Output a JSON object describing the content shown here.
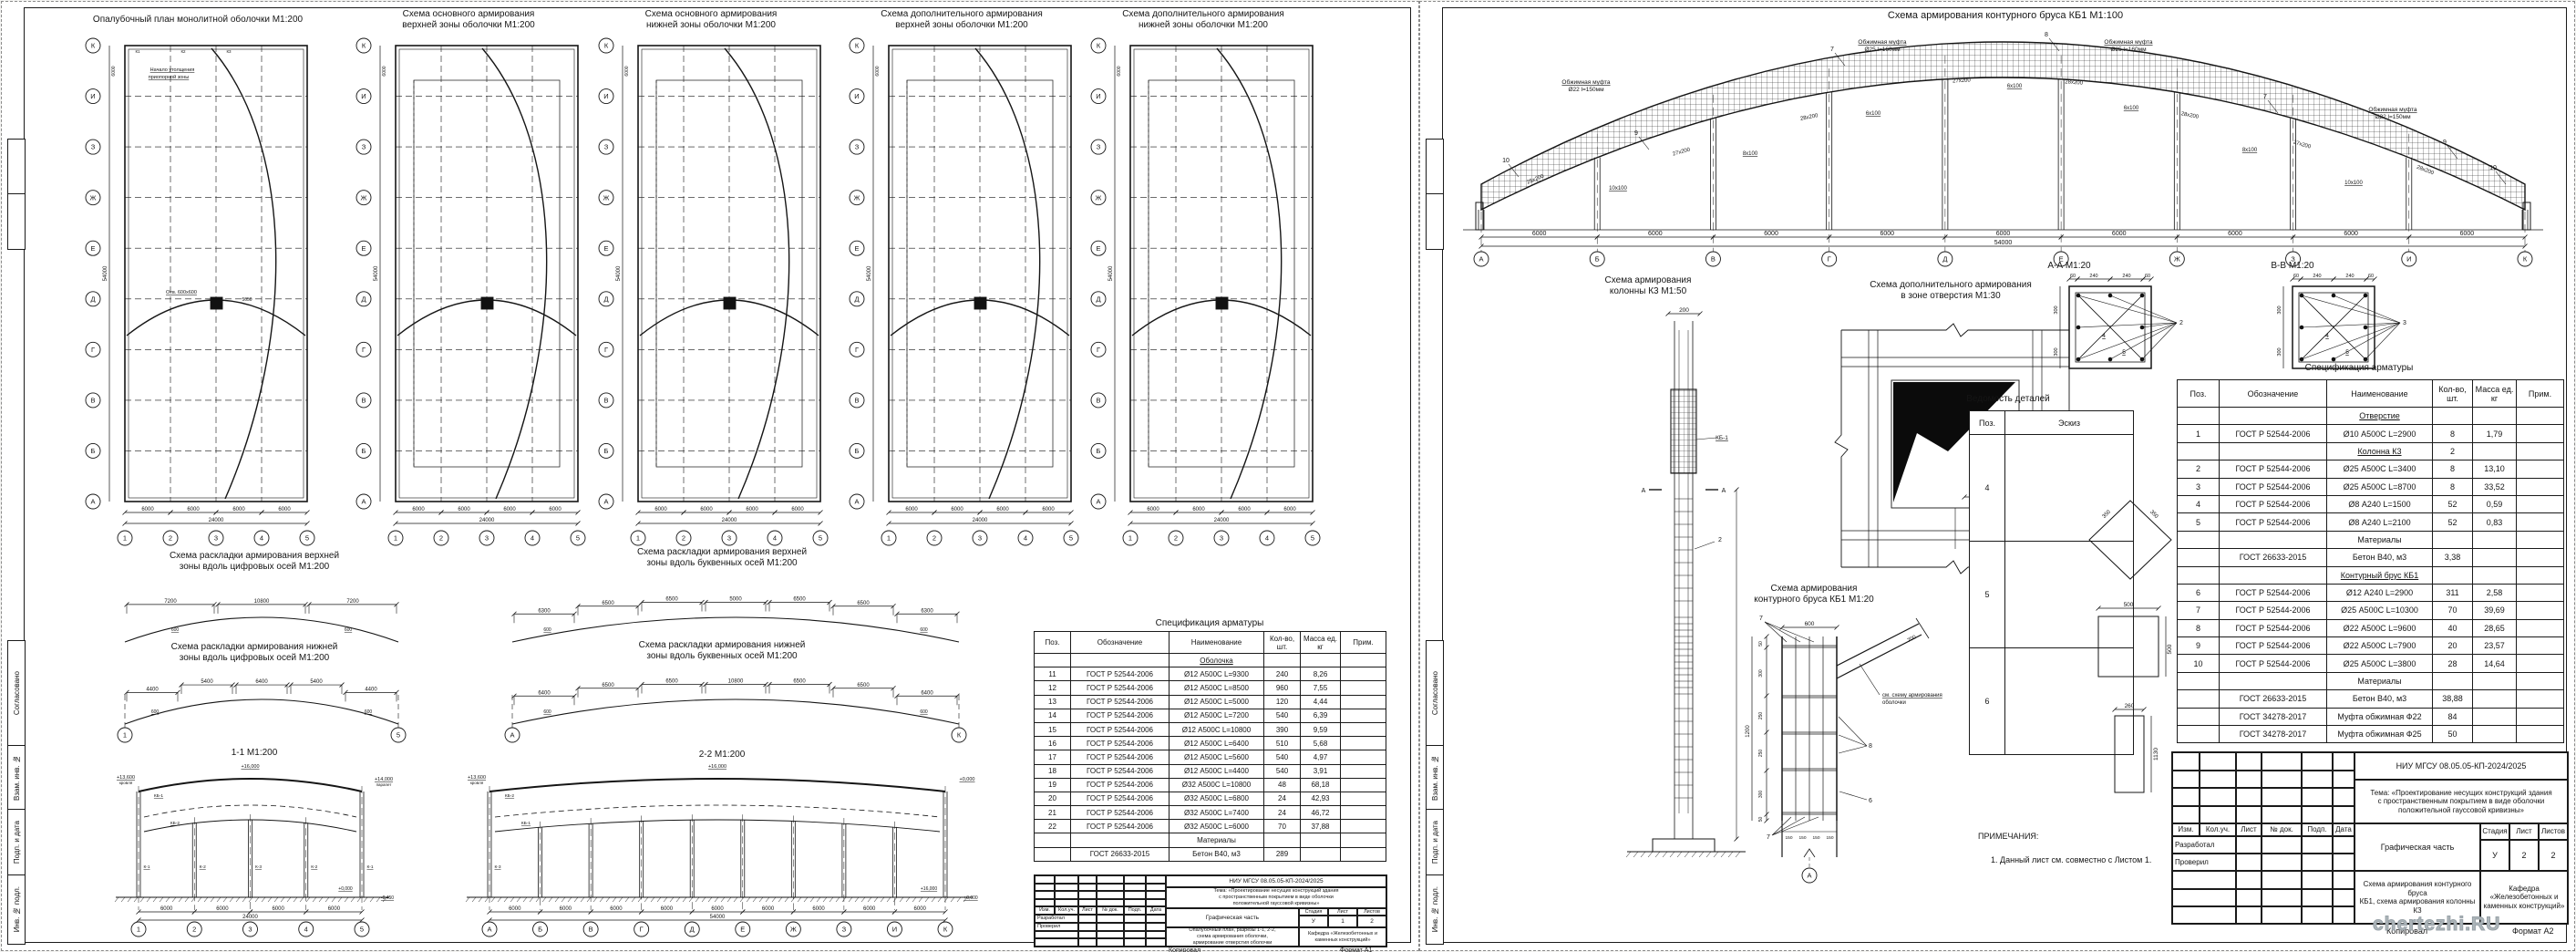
{
  "axes": {
    "letters": [
      "А",
      "Б",
      "В",
      "Г",
      "Д",
      "Е",
      "Ж",
      "З",
      "И",
      "К"
    ],
    "numbers": [
      "1",
      "2",
      "3",
      "4",
      "5"
    ],
    "bay": "6000",
    "total_width": "24000",
    "total_length": "54000"
  },
  "sheet1": {
    "plans": [
      {
        "title": "Опалубочный план монолитной оболочки М1:200"
      },
      {
        "title": "Схема основного армирования\nверхней зоны оболочки М1:200"
      },
      {
        "title": "Схема основного армирования\nнижней зоны оболочки М1:200"
      },
      {
        "title": "Схема дополнительного армирования\nверхней зоны оболочки М1:200"
      },
      {
        "title": "Схема дополнительного армирования\nнижней зоны оболочки М1:200"
      }
    ],
    "plan_note": "Начало утолщения\nприопорной зоны",
    "opening_label": "Отв. 600х600",
    "opening_dim": "5050",
    "column_tags": [
      "К1",
      "К2",
      "К3"
    ],
    "layout_schemes": [
      {
        "title": "Схема раскладки армирования верхней\nзоны вдоль цифровых осей М1:200",
        "dims": [
          "7200",
          "10800",
          "7200"
        ],
        "sub": "600"
      },
      {
        "title": "Схема раскладки армирования нижней\nзоны вдоль цифровых осей М1:200",
        "dims": [
          "4400",
          "5400",
          "6400",
          "5400",
          "4400"
        ],
        "sub": "600"
      },
      {
        "title": "Схема раскладки армирования верхней\nзоны вдоль буквенных осей М1:200",
        "dims": [
          "6300",
          "6500",
          "6500",
          "5000",
          "6500",
          "6500",
          "6300"
        ],
        "sub": "600"
      },
      {
        "title": "Схема раскладки армирования нижней\nзоны вдоль буквенных осей М1:200",
        "dims": [
          "6400",
          "6500",
          "6500",
          "10800",
          "6500",
          "6500",
          "6400"
        ],
        "sub": "600"
      }
    ],
    "sections": [
      {
        "label": "1-1 М1:200",
        "flags": [
          "+13,600",
          "+16,000",
          "+14,000",
          "+0,000",
          "-0,450"
        ],
        "flag_subs": [
          "кровля",
          "кровля",
          "парапет"
        ],
        "col_tags": [
          "К-1",
          "К-2",
          "К-3",
          "К-2",
          "К-1"
        ],
        "beam_tags": [
          "КБ-1",
          "КБ-2"
        ]
      },
      {
        "label": "2-2 М1:200",
        "flags": [
          "+13,600",
          "+16,000",
          "+0,000"
        ],
        "flag_subs": [
          "кровля"
        ],
        "col_tags": [
          "К-3"
        ],
        "beam_tags": [
          "КБ-2",
          "КБ-1"
        ]
      }
    ],
    "spec_title": "Спецификация арматуры",
    "spec_header": [
      "Поз.",
      "Обозначение",
      "Наименование",
      "Кол-во,\nшт.",
      "Масса ед.\nкг",
      "Прим."
    ],
    "spec_rows": [
      [
        "",
        "",
        "Оболочка",
        "",
        "",
        "",
        1
      ],
      [
        "11",
        "ГОСТ Р 52544-2006",
        "Ø12 А500С L=9300",
        "240",
        "8,26",
        "",
        0
      ],
      [
        "12",
        "ГОСТ Р 52544-2006",
        "Ø12 А500С L=8500",
        "960",
        "7,55",
        "",
        0
      ],
      [
        "13",
        "ГОСТ Р 52544-2006",
        "Ø12 А500С L=5000",
        "120",
        "4,44",
        "",
        0
      ],
      [
        "14",
        "ГОСТ Р 52544-2006",
        "Ø12 А500С L=7200",
        "540",
        "6,39",
        "",
        0
      ],
      [
        "15",
        "ГОСТ Р 52544-2006",
        "Ø12 А500С L=10800",
        "390",
        "9,59",
        "",
        0
      ],
      [
        "16",
        "ГОСТ Р 52544-2006",
        "Ø12 А500С L=6400",
        "510",
        "5,68",
        "",
        0
      ],
      [
        "17",
        "ГОСТ Р 52544-2006",
        "Ø12 А500С L=5600",
        "540",
        "4,97",
        "",
        0
      ],
      [
        "18",
        "ГОСТ Р 52544-2006",
        "Ø12 А500С L=4400",
        "540",
        "3,91",
        "",
        0
      ],
      [
        "19",
        "ГОСТ Р 52544-2006",
        "Ø32 А500С L=10800",
        "48",
        "68,18",
        "",
        0
      ],
      [
        "20",
        "ГОСТ Р 52544-2006",
        "Ø32 А500С L=6800",
        "24",
        "42,93",
        "",
        0
      ],
      [
        "21",
        "ГОСТ Р 52544-2006",
        "Ø32 А500С L=7400",
        "24",
        "46,72",
        "",
        0
      ],
      [
        "22",
        "ГОСТ Р 52544-2006",
        "Ø32 А500С L=6000",
        "70",
        "37,88",
        "",
        0
      ],
      [
        "",
        "",
        "Материалы",
        "",
        "",
        "",
        0
      ],
      [
        "",
        "ГОСТ 26633-2015",
        "Бетон В40, м3",
        "289",
        "",
        "",
        0
      ]
    ],
    "titleblock": {
      "code": "НИУ МГСУ 08.05.05-КП-2024/2025",
      "theme": "Тема: «Проектирование несущих конструкций здания\nс пространственным покрытием в виде оболочки\nположительной гауссовой кривизны»",
      "doc": "Графическая часть",
      "stage_label": "Стадия",
      "sheet_label": "Лист",
      "sheets_label": "Листов",
      "stage": "У",
      "sheet_no": "1",
      "sheets": "2",
      "content": "Опалубочный план, разрезы 1-1, 2-2,\nсхема армирования оболочки,\nармирование отверстия оболочки",
      "dept": "Кафедра «Железобетонных и\nкаменных конструкций»",
      "cols": [
        "Изм.",
        "Кол.уч.",
        "Лист",
        "№ док.",
        "Подп.",
        "Дата"
      ],
      "sigs": [
        "Разработал",
        "Проверил"
      ],
      "copy": "Копировал",
      "format": "Формат А1"
    }
  },
  "sheet2": {
    "arch": {
      "title": "Схема армирования контурного бруса КБ1 М1:100",
      "mufta22": "Обжимная муфта\nØ22 l=150мм",
      "mufta25": "Обжимная муфта\nØ25 l=160мм",
      "spacings": [
        "25x200",
        "10x100",
        "27x200",
        "8x100",
        "28x200",
        "6x100",
        "27x200",
        "6x100",
        "28x200",
        "6x100",
        "28x200",
        "8x100",
        "27x200",
        "10x100",
        "28x200"
      ],
      "callouts": [
        "7",
        "8",
        "9",
        "10"
      ]
    },
    "column": {
      "title": "Схема армирования\nколонны К3 М1:50",
      "top_dim": "200",
      "kb_label": "КБ-1",
      "callout": "2",
      "marker": "А"
    },
    "opening": {
      "title": "Схема дополнительного армирования\nв зоне отверстия М1:30",
      "dims": [
        "140",
        "200"
      ],
      "callout": "1"
    },
    "sectionA": {
      "title": "А-А М1:20",
      "callout": "2"
    },
    "sectionB": {
      "title": "В-В М1:20",
      "callout": "3"
    },
    "section_top_dims": [
      "60",
      "240",
      "240",
      "60"
    ],
    "section_side_dims": [
      "300",
      "300"
    ],
    "section_inner": [
      "4",
      "5"
    ],
    "kb1": {
      "title": "Схема армирования\nконтурного бруса КБ1 М1:20",
      "top_dim": "600",
      "side_dims": [
        "50",
        "300",
        "250",
        "250",
        "300",
        "50"
      ],
      "total": "1200",
      "bottom_dims": [
        "150",
        "150",
        "150",
        "150"
      ],
      "diag_dim": "700",
      "callouts": [
        "7",
        "8",
        "6"
      ],
      "axis": "А",
      "leader": "см. схему армирования\nоболочки"
    },
    "details_title": "Ведомость деталей",
    "details_header": [
      "Поз.",
      "Эскиз"
    ],
    "details_rows": [
      {
        "pos": "4",
        "type": "diamond",
        "dims": [
          "350",
          "350"
        ]
      },
      {
        "pos": "5",
        "type": "square",
        "dims": [
          "500",
          "500"
        ]
      },
      {
        "pos": "6",
        "type": "rect",
        "dims": [
          "260",
          "1130"
        ]
      }
    ],
    "spec_title": "Спецификация арматуры",
    "spec_header": [
      "Поз.",
      "Обозначение",
      "Наименование",
      "Кол-во,\nшт.",
      "Масса ед.\nкг",
      "Прим."
    ],
    "spec_rows": [
      [
        "",
        "",
        "Отверстие",
        "",
        "",
        "",
        1
      ],
      [
        "1",
        "ГОСТ Р 52544-2006",
        "Ø10 А500С L=2900",
        "8",
        "1,79",
        "",
        0
      ],
      [
        "",
        "",
        "Колонна К3",
        "2",
        "",
        "",
        1
      ],
      [
        "2",
        "ГОСТ Р 52544-2006",
        "Ø25 А500С L=3400",
        "8",
        "13,10",
        "",
        0
      ],
      [
        "3",
        "ГОСТ Р 52544-2006",
        "Ø25 А500С L=8700",
        "8",
        "33,52",
        "",
        0
      ],
      [
        "4",
        "ГОСТ Р 52544-2006",
        "Ø8 А240 L=1500",
        "52",
        "0,59",
        "",
        0
      ],
      [
        "5",
        "ГОСТ Р 52544-2006",
        "Ø8 А240 L=2100",
        "52",
        "0,83",
        "",
        0
      ],
      [
        "",
        "",
        "Материалы",
        "",
        "",
        "",
        0
      ],
      [
        "",
        "ГОСТ 26633-2015",
        "Бетон  В40, м3",
        "3,38",
        "",
        "",
        0
      ],
      [
        "",
        "",
        "Контурный брус КБ1",
        "",
        "",
        "",
        1
      ],
      [
        "6",
        "ГОСТ Р 52544-2006",
        "Ø12 А240 L=2900",
        "311",
        "2,58",
        "",
        0
      ],
      [
        "7",
        "ГОСТ Р 52544-2006",
        "Ø25 А500С L=10300",
        "70",
        "39,69",
        "",
        0
      ],
      [
        "8",
        "ГОСТ Р 52544-2006",
        "Ø22 А500С L=9600",
        "40",
        "28,65",
        "",
        0
      ],
      [
        "9",
        "ГОСТ Р 52544-2006",
        "Ø22 А500С L=7900",
        "20",
        "23,57",
        "",
        0
      ],
      [
        "10",
        "ГОСТ Р 52544-2006",
        "Ø25 А500С L=3800",
        "28",
        "14,64",
        "",
        0
      ],
      [
        "",
        "",
        "Материалы",
        "",
        "",
        "",
        0
      ],
      [
        "",
        "ГОСТ 26633-2015",
        "Бетон  В40, м3",
        "38,88",
        "",
        "",
        0
      ],
      [
        "",
        "ГОСТ 34278-2017",
        "Муфта обжимная Ф22",
        "84",
        "",
        "",
        0
      ],
      [
        "",
        "ГОСТ 34278-2017",
        "Муфта обжимная Ф25",
        "50",
        "",
        "",
        0
      ]
    ],
    "notes_title": "ПРИМЕЧАНИЯ:",
    "notes_line": "1. Данный лист см. совместно с Листом 1.",
    "titleblock": {
      "code": "НИУ МГСУ 08.05.05-КП-2024/2025",
      "theme": "Тема: «Проектирование несущих конструкций здания\nс пространственным покрытием в виде оболочки\nположительной гауссовой кривизны»",
      "doc": "Графическая часть",
      "stage_label": "Стадия",
      "sheet_label": "Лист",
      "sheets_label": "Листов",
      "stage": "У",
      "sheet_no": "2",
      "sheets": "2",
      "content": "Схема армирования контурного бруса\nКБ1, схема армирования колонны К3",
      "dept": "Кафедра «Железобетонных и\nкаменных конструкций»",
      "cols": [
        "Изм.",
        "Кол.уч.",
        "Лист",
        "№ док.",
        "Подп.",
        "Дата"
      ],
      "sigs": [
        "Разработал",
        "Проверил"
      ],
      "copy": "Копировал",
      "format": "Формат А2"
    }
  },
  "side_stamp_labels": [
    "Согласовано",
    "Взам. инв. №",
    "Подп. и дата",
    "Инв. № подл."
  ],
  "watermark": "chertezhi.RU"
}
